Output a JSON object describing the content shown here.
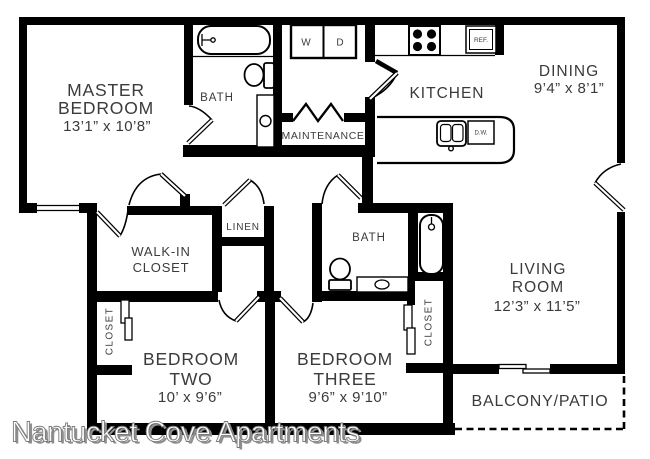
{
  "watermark": {
    "text": "Nantucket Cove Apartments"
  },
  "rooms": {
    "master": {
      "line1": "MASTER",
      "line2": "BEDROOM",
      "dims": "13’1” x 10’8”"
    },
    "bath_top": {
      "label": "BATH"
    },
    "maintenance": {
      "label": "MAINTENANCE"
    },
    "kitchen": {
      "label": "KITCHEN"
    },
    "dining": {
      "line1": "DINING",
      "dims": "9’4” x 8’1”"
    },
    "walkin": {
      "line1": "WALK-IN",
      "line2": "CLOSET"
    },
    "linen": {
      "label": "LINEN"
    },
    "bath_hall": {
      "label": "BATH"
    },
    "living": {
      "line1": "LIVING",
      "line2": "ROOM",
      "dims": "12’3” x 11’5”"
    },
    "closet_left": {
      "label": "CLOSET"
    },
    "closet_right": {
      "label": "CLOSET"
    },
    "bedroom_two": {
      "line1": "BEDROOM",
      "line2": "TWO",
      "dims": "10’ x 9’6”"
    },
    "bedroom_three": {
      "line1": "BEDROOM",
      "line2": "THREE",
      "dims": "9’6” x 9’10”"
    },
    "balcony": {
      "label": "BALCONY/PATIO"
    }
  },
  "appliances": {
    "washer": "W",
    "dryer": "D",
    "refrigerator": "REF.",
    "dishwasher": "D.W."
  },
  "colors": {
    "wall": "#000000",
    "label": "#3b3b3b",
    "background": "#ffffff",
    "watermark_fill": "#ffffff",
    "watermark_outline": "#7a7a7a"
  }
}
